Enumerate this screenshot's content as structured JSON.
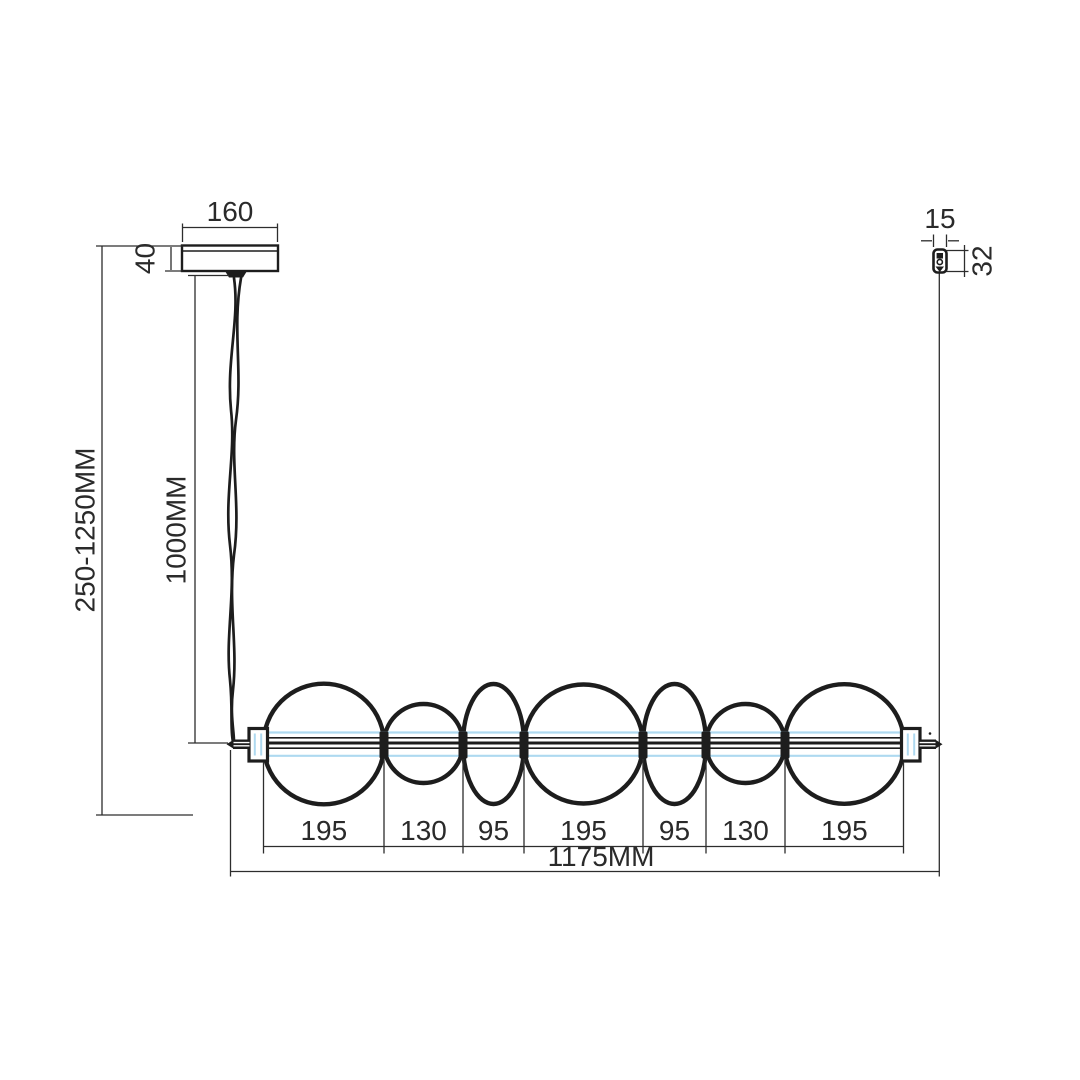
{
  "dimensions": {
    "canopy_width": "160",
    "canopy_height": "40",
    "suspension_height_range": "250-1250MM",
    "cable_length": "1000MM",
    "wire_grip_width": "15",
    "wire_grip_height": "32",
    "overall_length": "1175MM",
    "segment_widths": [
      "195",
      "130",
      "95",
      "195",
      "95",
      "130",
      "195"
    ]
  },
  "colors": {
    "line": "#1d1d1d",
    "dimension_line": "#2d2d2d",
    "glass_accent_blue": "#aed9f0",
    "background": "#ffffff"
  }
}
